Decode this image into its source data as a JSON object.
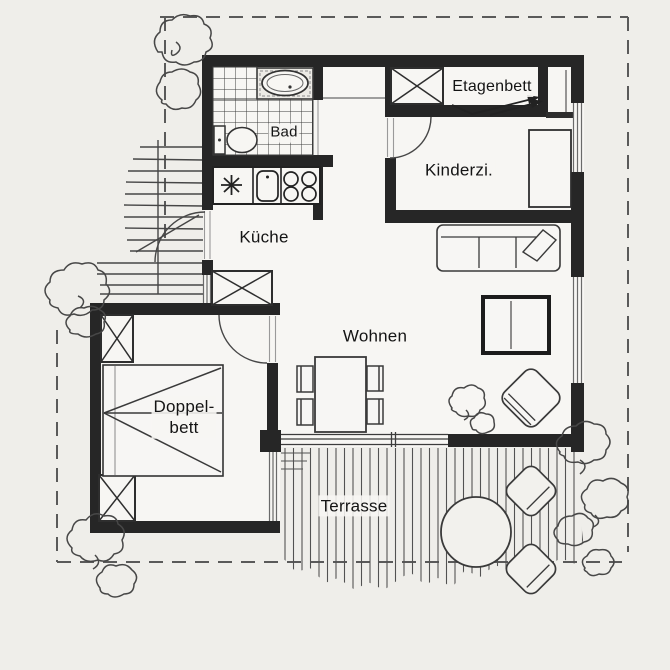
{
  "plan": {
    "title": "apartment floor plan",
    "rooms": [
      {
        "id": "bad",
        "label": "Bad"
      },
      {
        "id": "etagenbett",
        "label": "Etagenbett"
      },
      {
        "id": "kinderzimmer",
        "label": "Kinderzi."
      },
      {
        "id": "kueche",
        "label": "Küche"
      },
      {
        "id": "wohnen",
        "label": "Wohnen"
      },
      {
        "id": "doppelbett",
        "label_line1": "Doppel-",
        "label_line2": "bett"
      },
      {
        "id": "terrasse",
        "label": "Terrasse"
      }
    ]
  },
  "colors": {
    "wall": "#262626",
    "line": "#3f3f3f",
    "light_line": "#9a9a9a",
    "dashed_boundary": "#5a5a5a",
    "background": "#efeeea",
    "interior_floor": "#f7f6f3",
    "text": "#141414"
  }
}
